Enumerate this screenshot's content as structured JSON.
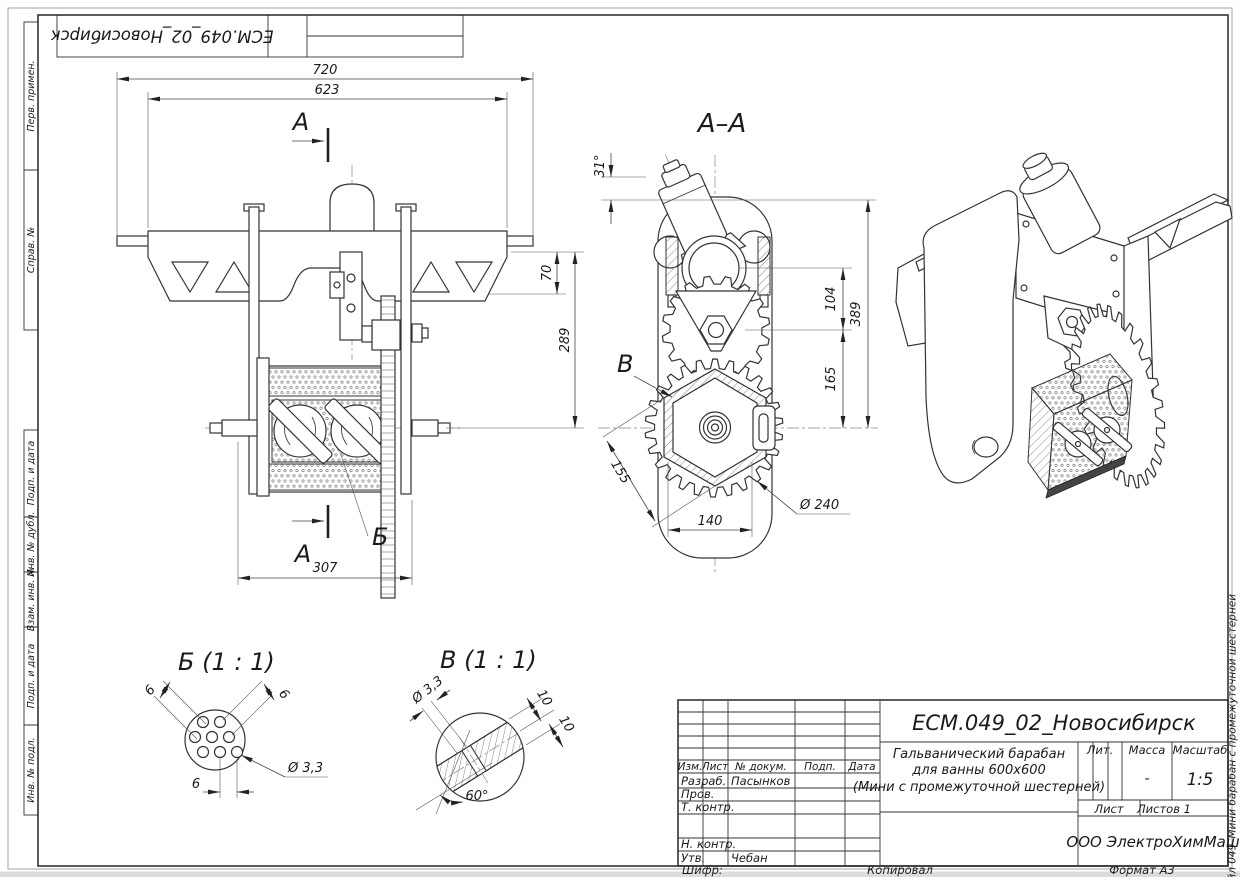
{
  "frame": {
    "top_stamp": "ЕСМ.049_02_Новосибирск",
    "margin_labels": [
      "Перв. примен.",
      "Справ. №",
      "Подп. и дата",
      "Инв. № дубл.",
      "Взам. инв. №",
      "Подп. и дата",
      "Инв. № подл."
    ],
    "file_note": "Файл 049_Мини барабан с промежуточной шестерней",
    "footer": {
      "shifr": "Шифр:",
      "kopiroval": "Копировал",
      "format": "Формат А3"
    }
  },
  "title_block": {
    "designation": "ЕСМ.049_02_Новосибирск",
    "product_name": [
      "Гальванический барабан",
      "для ванны 600x600",
      "(Мини с промежуточной шестерней)"
    ],
    "cols": {
      "izm": "Изм.",
      "list": "Лист",
      "ndoc": "№ докум.",
      "podp": "Подп.",
      "data": "Дата"
    },
    "rows": {
      "razrab": "Разраб.",
      "prov": "Пров.",
      "tkontr": "Т. контр.",
      "nkontr": "Н. контр.",
      "utv": "Утв."
    },
    "people": {
      "razrab": "Пасынков",
      "utv": "Чебан"
    },
    "lit_label": "Лит.",
    "massa_label": "Масса",
    "masshtab_label": "Масштаб",
    "massa_value": "-",
    "masshtab_value": "1:5",
    "list_label": "Лист",
    "listov_label": "Листов 1",
    "company": "ООО ЭлектроХимМаш"
  },
  "front_view": {
    "dim_720": "720",
    "dim_623": "623",
    "dim_70": "70",
    "dim_289": "289",
    "dim_307": "307",
    "section_letter_top": "А",
    "section_letter_bottom": "А",
    "detail_letter": "Б"
  },
  "section_view": {
    "title": "А–А",
    "dim_angle": "31°",
    "dim_104": "104",
    "dim_389": "389",
    "dim_165": "165",
    "dim_155": "155",
    "dim_140": "140",
    "dim_d240": "Ø 240",
    "detail_letter": "В"
  },
  "detail_b": {
    "title": "Б (1 : 1)",
    "dim_6a": "6",
    "dim_6b": "6",
    "dim_6c": "6",
    "dim_d33": "Ø 3,3"
  },
  "detail_v": {
    "title": "В (1 : 1)",
    "dim_d33": "Ø 3,3",
    "dim_10a": "10",
    "dim_10b": "10",
    "dim_60": "60°"
  }
}
